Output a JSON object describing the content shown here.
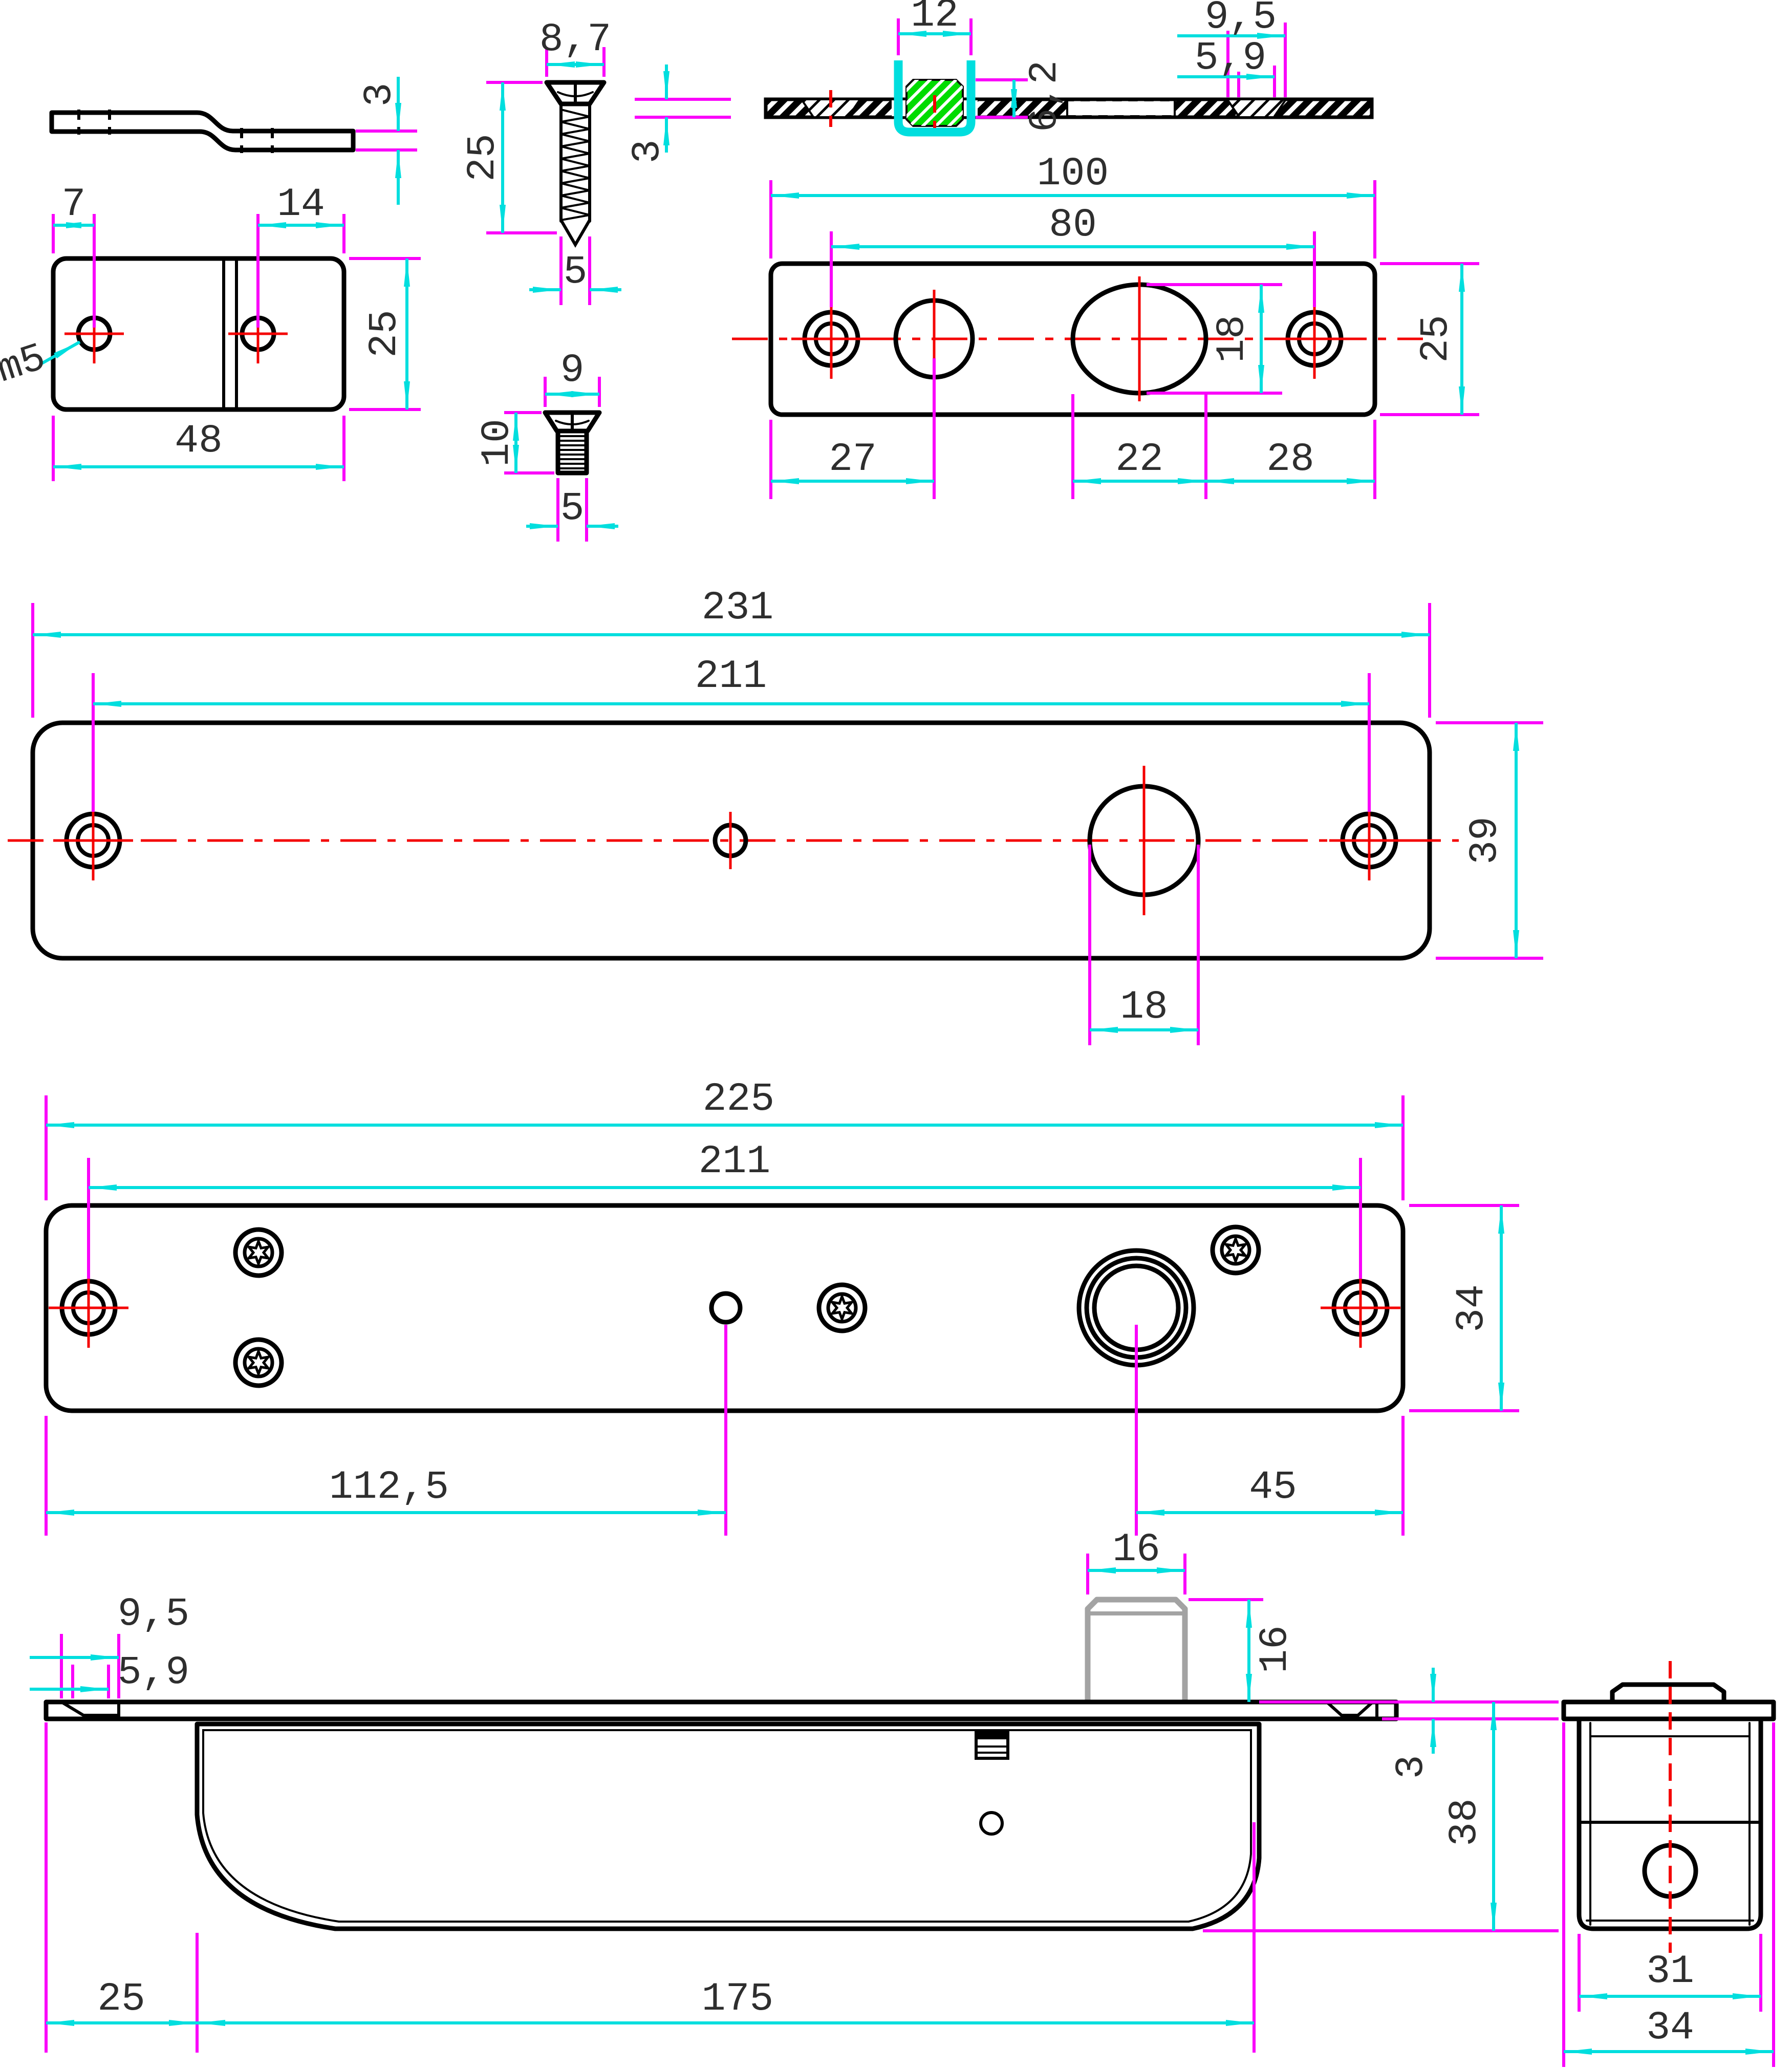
{
  "drawing": {
    "type": "technical-cad-drawing",
    "subject": "sliding door lock assembly - dimensioned multi-view drawing",
    "units": "mm",
    "colors": {
      "outline": "#000000",
      "dimension_lines": "#00dede",
      "extension_lines": "#fa00fa",
      "centerlines": "#f40000",
      "highlight_insert": "#00dc00",
      "bolt_gray": "#a3a3a3",
      "text": "#2e2e2e",
      "background": "#ffffff"
    },
    "views": {
      "bracket_side": {
        "dims": {
          "thickness": "3"
        }
      },
      "bracket_plan": {
        "dims": {
          "hole1_offset": "7",
          "hole2_offset": "14",
          "height": "25",
          "width": "48",
          "thread_label": "m5"
        }
      },
      "wood_screw": {
        "dims": {
          "head_dia": "8,7",
          "length": "25",
          "shank_dia": "5"
        }
      },
      "machine_screw": {
        "dims": {
          "head_dia": "9",
          "length": "10",
          "shank_dia": "5"
        }
      },
      "section_view": {
        "dims": {
          "insert_width": "12",
          "insert_height": "6,2",
          "plate_thickness": "3",
          "countersink_outer": "9,5",
          "countersink_inner": "5,9"
        }
      },
      "faceplate": {
        "dims": {
          "width": "100",
          "hole_span": "80",
          "height": "25",
          "cylinder_height": "18",
          "left_hole_offset": "27",
          "cylinder_width": "22",
          "right_hole_offset": "28"
        }
      },
      "cover_plate": {
        "dims": {
          "width": "231",
          "hole_span": "211",
          "height": "39",
          "hole_dia": "18"
        }
      },
      "mount_plate": {
        "dims": {
          "width": "225",
          "hole_span": "211",
          "height": "34",
          "center_offset": "112,5",
          "boss_offset": "45"
        }
      },
      "body_side": {
        "dims": {
          "countersink_outer": "9,5",
          "countersink_inner": "5,9",
          "bolt_width": "16",
          "bolt_height": "16",
          "plate_thickness": "3",
          "total_height": "38",
          "left_offset": "25",
          "body_length": "175"
        }
      },
      "body_end": {
        "dims": {
          "inner_width": "31",
          "outer_width": "34"
        }
      }
    }
  }
}
